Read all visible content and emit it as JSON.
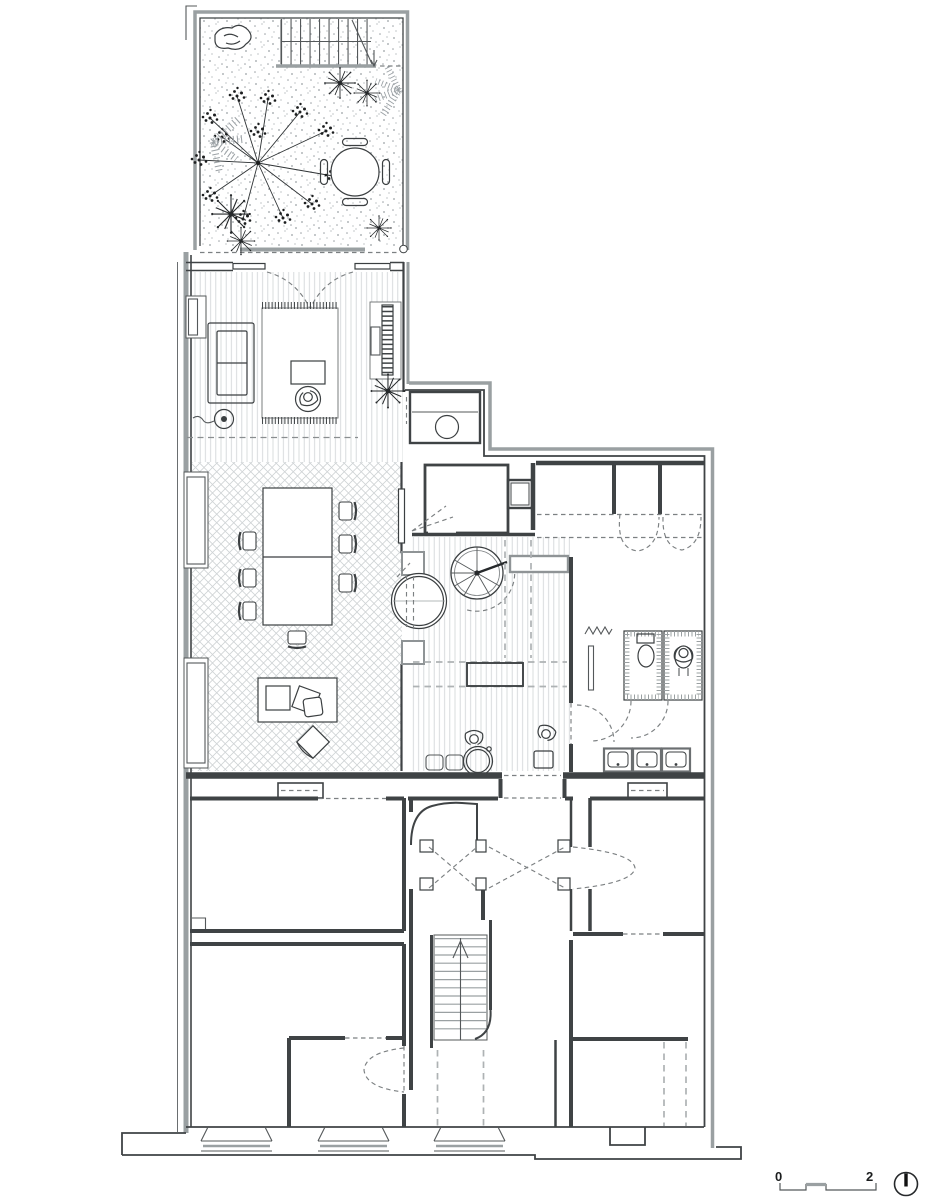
{
  "page": {
    "background": "#ffffff"
  },
  "drawing": {
    "kind": "architectural-floor-plan",
    "scale_bar": {
      "start_label": "0",
      "end_label": "2"
    },
    "north_indicator": "circle-with-needle"
  },
  "colors": {
    "ink": "#3f4345",
    "party_wall_gray": "#9aa0a2",
    "pattern_gray": "#cfd3d5",
    "dash_gray": "#7c8082",
    "background": "#ffffff"
  }
}
